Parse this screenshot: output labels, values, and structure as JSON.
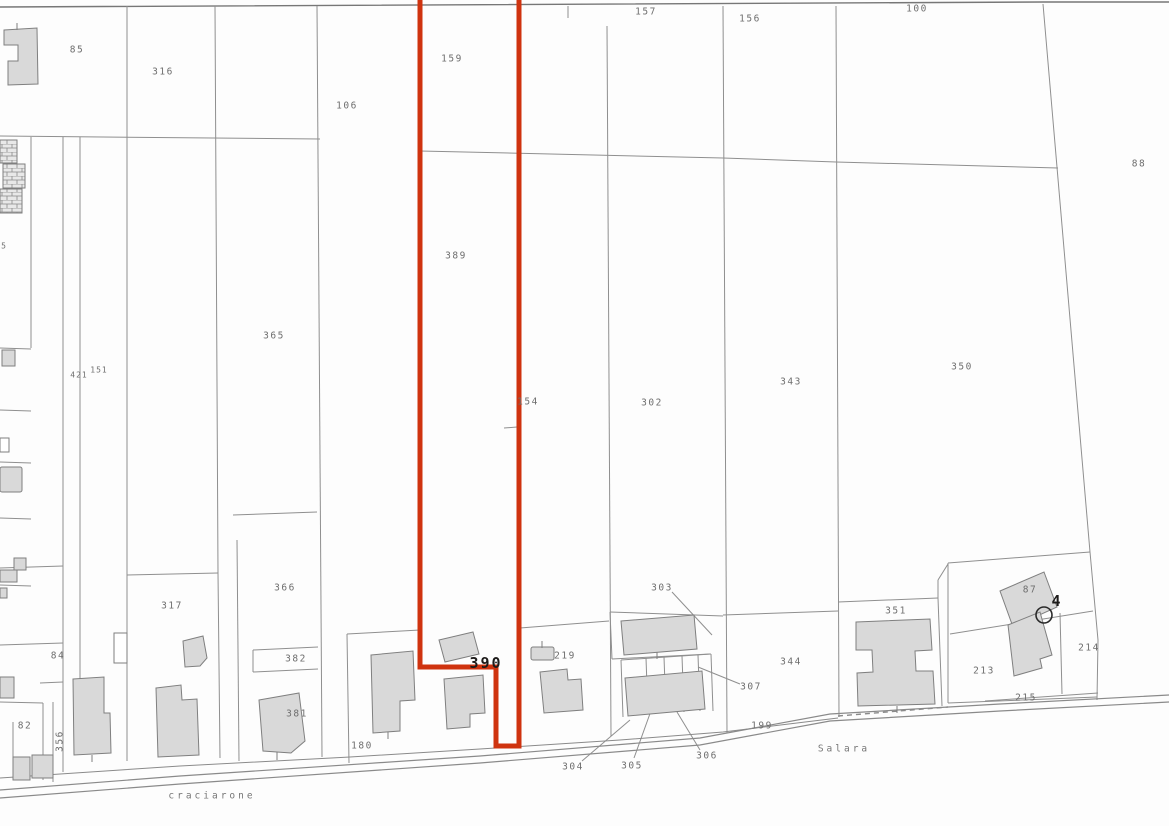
{
  "map": {
    "type": "cadastral-parcel-map",
    "highlighted_parcel": "390",
    "colors": {
      "highlight": "#cf330f",
      "boundary_line": "#8f8f8f",
      "building_fill": "#d9d9d9",
      "building_stroke": "#7f7f7f",
      "label": "#6e6e6e"
    },
    "labels": [
      {
        "text": "85",
        "x": 77,
        "y": 50,
        "kind": "parcel"
      },
      {
        "text": "316",
        "x": 163,
        "y": 72,
        "kind": "parcel"
      },
      {
        "text": "106",
        "x": 347,
        "y": 106,
        "kind": "parcel"
      },
      {
        "text": "159",
        "x": 452,
        "y": 59,
        "kind": "parcel"
      },
      {
        "text": "157",
        "x": 646,
        "y": 12,
        "kind": "parcel"
      },
      {
        "text": "156",
        "x": 750,
        "y": 19,
        "kind": "parcel"
      },
      {
        "text": "100",
        "x": 917,
        "y": 9,
        "kind": "parcel"
      },
      {
        "text": "88",
        "x": 1139,
        "y": 164,
        "kind": "parcel"
      },
      {
        "text": "389",
        "x": 456,
        "y": 256,
        "kind": "parcel"
      },
      {
        "text": "365",
        "x": 274,
        "y": 336,
        "kind": "parcel"
      },
      {
        "text": "421",
        "x": 79,
        "y": 375,
        "kind": "parcel",
        "small": true
      },
      {
        "text": "151",
        "x": 99,
        "y": 370,
        "kind": "parcel",
        "small": true
      },
      {
        "text": "154",
        "x": 528,
        "y": 402,
        "kind": "parcel"
      },
      {
        "text": "302",
        "x": 652,
        "y": 403,
        "kind": "parcel"
      },
      {
        "text": "343",
        "x": 791,
        "y": 382,
        "kind": "parcel"
      },
      {
        "text": "350",
        "x": 962,
        "y": 367,
        "kind": "parcel"
      },
      {
        "text": "5",
        "x": 4,
        "y": 246,
        "kind": "parcel",
        "small": true
      },
      {
        "text": "317",
        "x": 172,
        "y": 606,
        "kind": "parcel"
      },
      {
        "text": "366",
        "x": 285,
        "y": 588,
        "kind": "parcel"
      },
      {
        "text": "382",
        "x": 296,
        "y": 659,
        "kind": "parcel"
      },
      {
        "text": "381",
        "x": 297,
        "y": 714,
        "kind": "parcel"
      },
      {
        "text": "303",
        "x": 662,
        "y": 588,
        "kind": "parcel"
      },
      {
        "text": "84",
        "x": 58,
        "y": 656,
        "kind": "parcel"
      },
      {
        "text": "82",
        "x": 25,
        "y": 726,
        "kind": "parcel"
      },
      {
        "text": "356",
        "x": 60,
        "y": 741,
        "kind": "parcel",
        "rotate": -90
      },
      {
        "text": "180",
        "x": 362,
        "y": 746,
        "kind": "parcel"
      },
      {
        "text": "219",
        "x": 565,
        "y": 656,
        "kind": "parcel"
      },
      {
        "text": "390",
        "x": 486,
        "y": 663,
        "kind": "parcel-highlighted",
        "bold": true
      },
      {
        "text": "307",
        "x": 751,
        "y": 687,
        "kind": "parcel"
      },
      {
        "text": "344",
        "x": 791,
        "y": 662,
        "kind": "parcel"
      },
      {
        "text": "304",
        "x": 573,
        "y": 767,
        "kind": "parcel"
      },
      {
        "text": "305",
        "x": 632,
        "y": 766,
        "kind": "parcel"
      },
      {
        "text": "306",
        "x": 707,
        "y": 756,
        "kind": "parcel"
      },
      {
        "text": "199",
        "x": 762,
        "y": 726,
        "kind": "parcel"
      },
      {
        "text": "351",
        "x": 896,
        "y": 611,
        "kind": "parcel"
      },
      {
        "text": "87",
        "x": 1030,
        "y": 590,
        "kind": "parcel"
      },
      {
        "text": "4",
        "x": 1057,
        "y": 601,
        "kind": "point-number",
        "bold": true
      },
      {
        "text": "213",
        "x": 984,
        "y": 671,
        "kind": "parcel"
      },
      {
        "text": "214",
        "x": 1089,
        "y": 648,
        "kind": "parcel"
      },
      {
        "text": "215",
        "x": 1026,
        "y": 698,
        "kind": "parcel"
      },
      {
        "text": "Salara",
        "x": 844,
        "y": 749,
        "kind": "road"
      },
      {
        "text": "craciarone",
        "x": 212,
        "y": 796,
        "kind": "road"
      }
    ]
  }
}
